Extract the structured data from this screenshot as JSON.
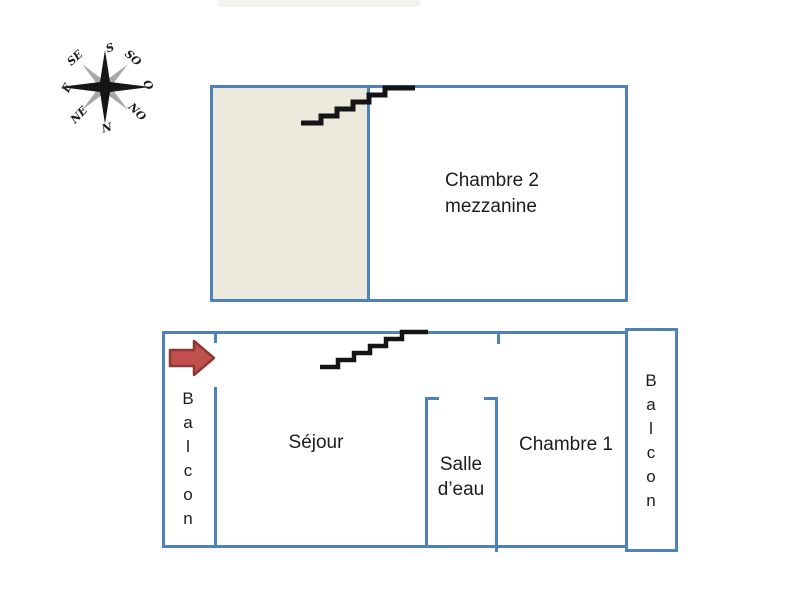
{
  "colors": {
    "wall_blue": "#4f81bd",
    "beige_fill": "#ece9dd",
    "arrow_fill": "#c0504d",
    "arrow_stroke": "#8c3836",
    "stairs_black": "#141414",
    "text_color": "#1c1c1c",
    "compass_black": "#161616",
    "compass_gray": "#a8a8a8"
  },
  "compass": {
    "labels": [
      {
        "text": "S"
      },
      {
        "text": "SO"
      },
      {
        "text": "O"
      },
      {
        "text": "NO"
      },
      {
        "text": "N"
      },
      {
        "text": "NE"
      },
      {
        "text": "E"
      },
      {
        "text": "SE"
      }
    ]
  },
  "upper_floor": {
    "room_label_line1": "Chambre 2",
    "room_label_line2": "mezzanine"
  },
  "lower_floor": {
    "sejour": "Séjour",
    "salle_eau_line1": "Salle",
    "salle_eau_line2": "d’eau",
    "chambre1": "Chambre 1",
    "balcon_left": "Balcon",
    "balcon_right": "Balcon"
  }
}
